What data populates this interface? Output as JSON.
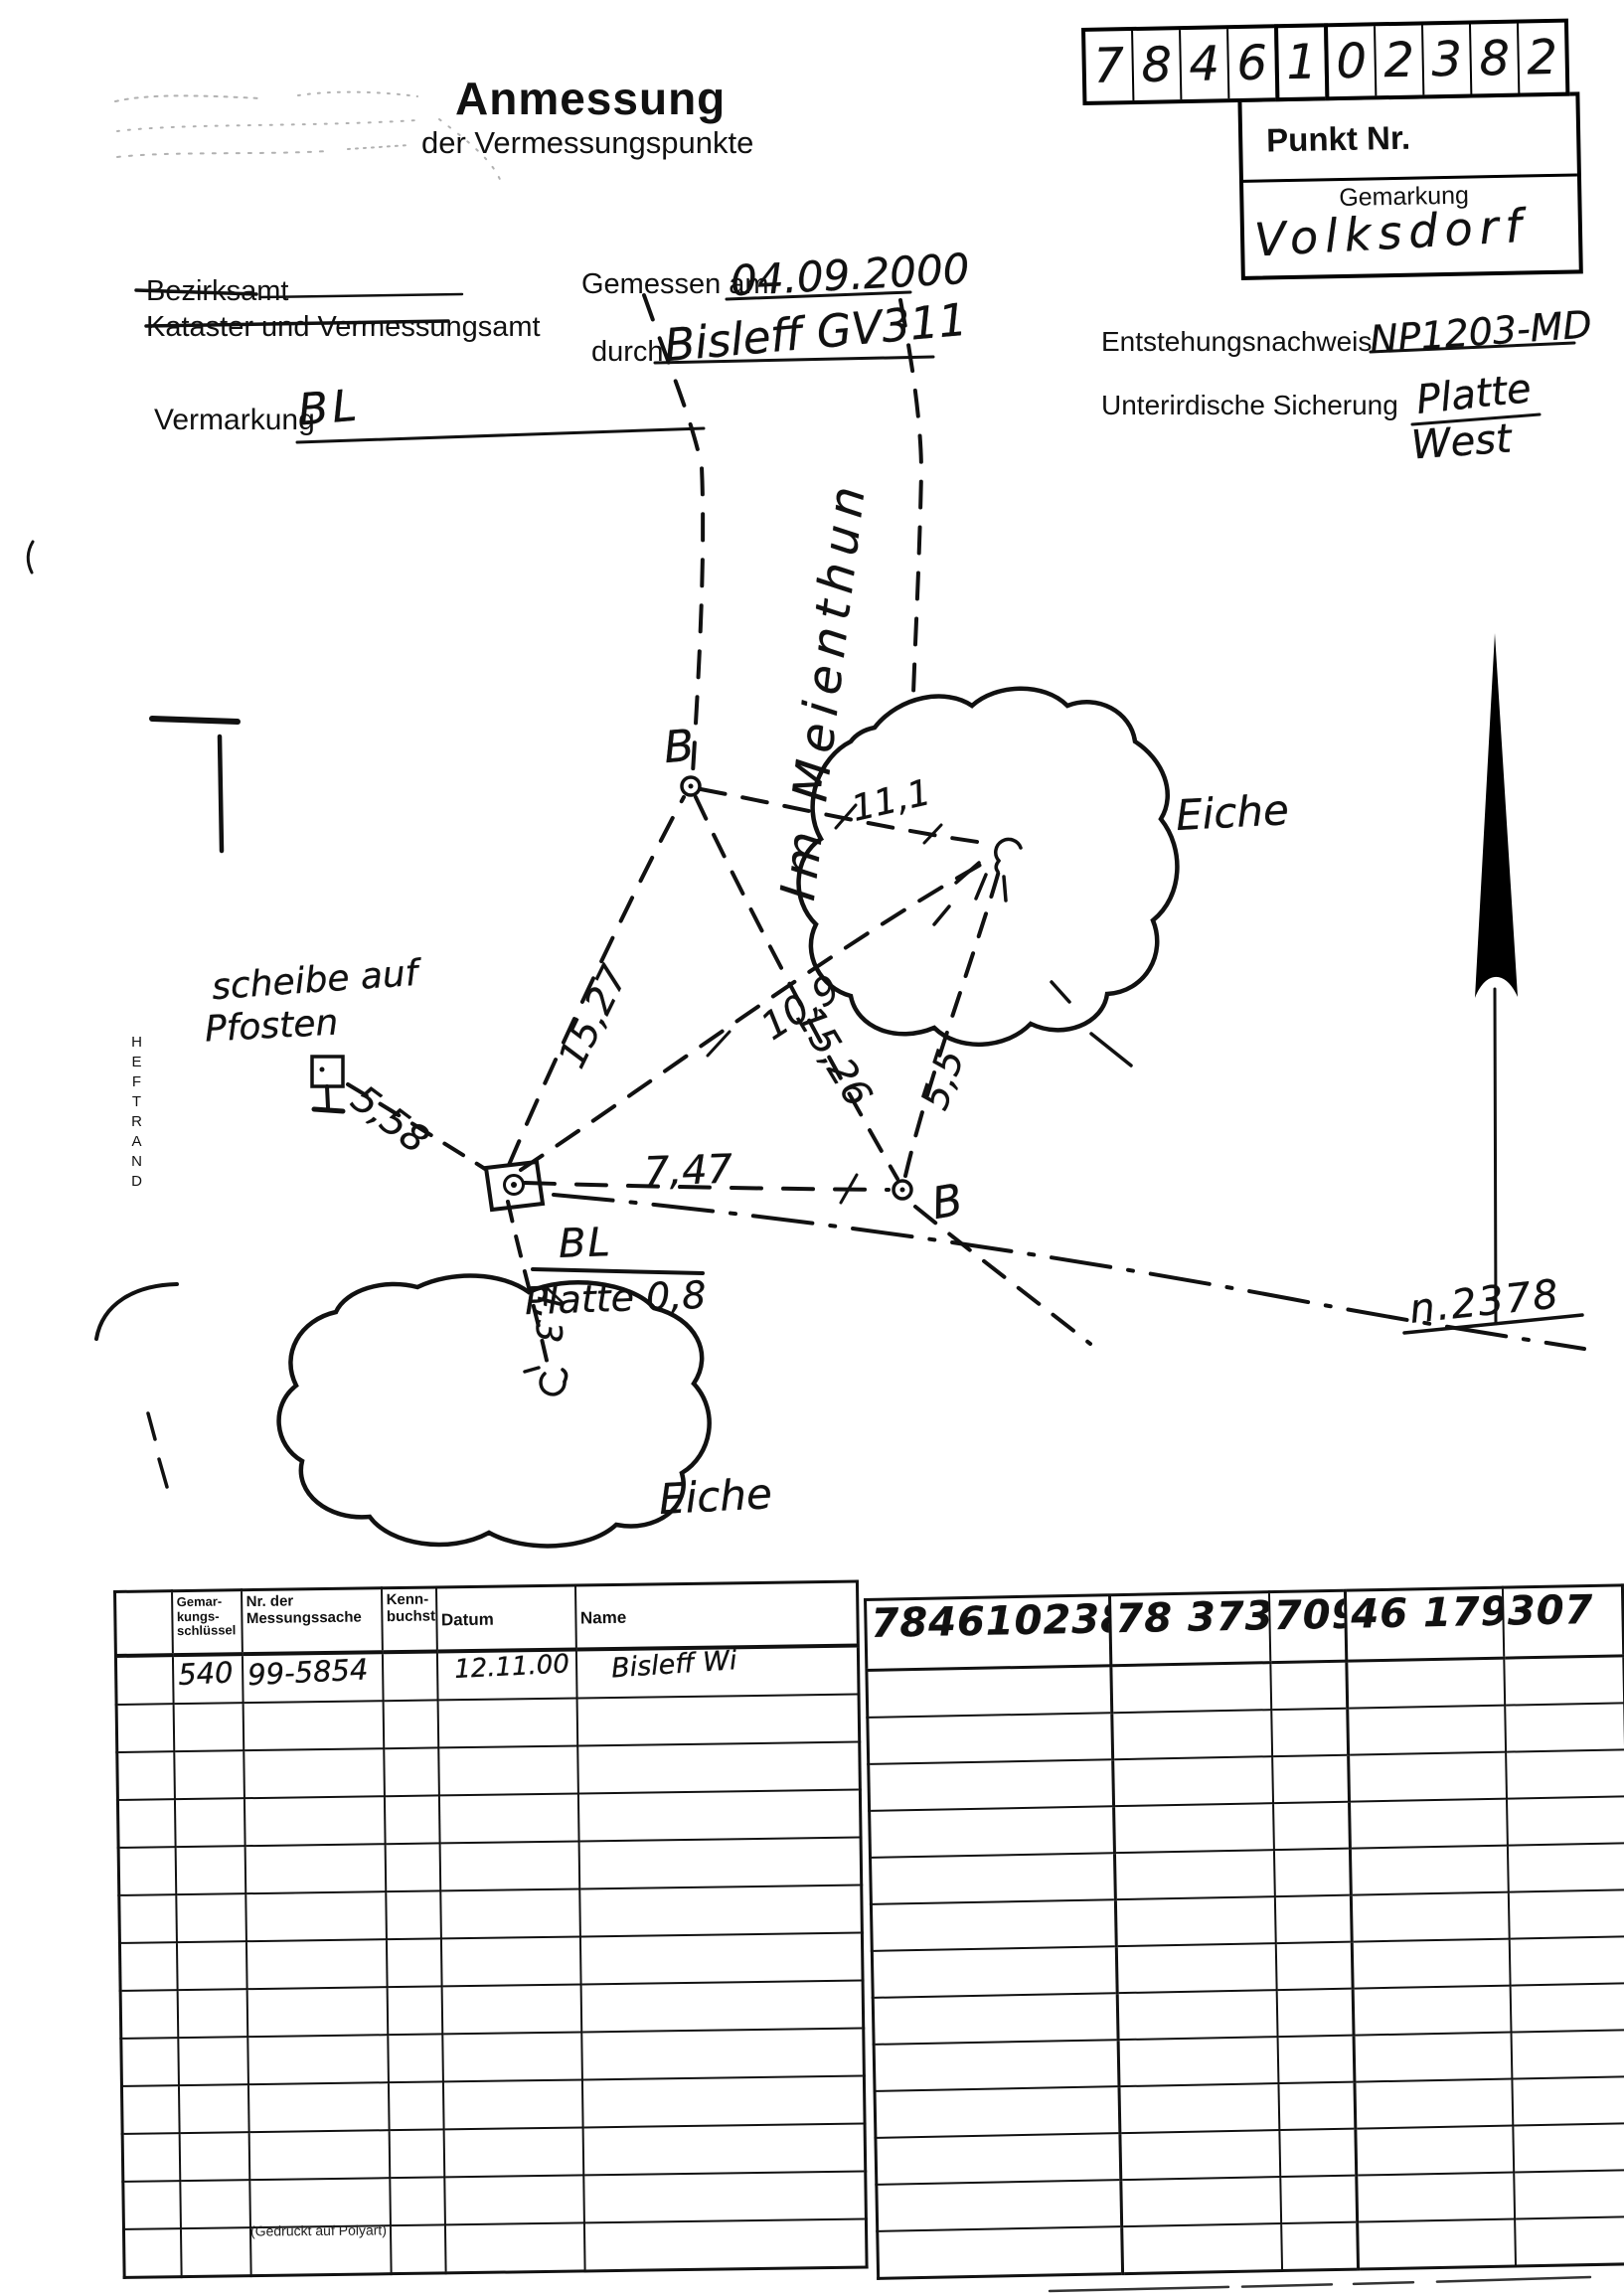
{
  "colors": {
    "paper": "#ffffff",
    "ink": "#111111"
  },
  "form": {
    "title": "Anmessung",
    "subtitle": "der Vermessungspunkte",
    "office_line1": "Bezirksamt",
    "office_line2": "Kataster und Vermessungsamt",
    "measured_on_label": "Gemessen am",
    "measured_on_value": "04.09.2000",
    "measured_by_label": "durch",
    "measured_by_value": "Bisleff GV311",
    "vermarkung_label": "Vermarkung",
    "vermarkung_value": "BL",
    "entstehungsnachweis_label": "Entstehungsnachweis",
    "entstehungsnachweis_value": "NP1203-MD",
    "sicherung_label": "Unterirdische Sicherung",
    "sicherung_value_line1": "Platte",
    "sicherung_value_line2": "West"
  },
  "punkt_box": {
    "digits_group1": [
      "7",
      "8",
      "4",
      "6"
    ],
    "digits_group2": [
      "1"
    ],
    "digits_group3": [
      "0",
      "2",
      "3",
      "8",
      "2"
    ],
    "punkt_nr_label": "Punkt Nr.",
    "gemarkung_label": "Gemarkung",
    "gemarkung_value": "Volksdorf"
  },
  "sketch": {
    "street_name": "Im Meienthun",
    "heftrand": "HEFTRAND",
    "point_b_top": "B",
    "point_b_right": "B",
    "tree_right_label": "Eiche",
    "tree_bottom_label": "Eiche",
    "post_label_line1": "scheibe auf",
    "post_label_line2": "Pfosten",
    "center_point_label_line1": "BL",
    "center_point_label_line2": "Platte 0,8",
    "neighbor_point_label": "n.2378",
    "measurements": {
      "square_to_b_top": "15,27",
      "square_to_tree": "10,9",
      "b_top_to_b_right": "15,26",
      "b_right_to_tree": "5,5",
      "b_top_to_tree": "11,1",
      "post_to_square": "5,58",
      "square_to_b_right": "7,47",
      "square_to_tree_bottom": "4,3"
    }
  },
  "table_left": {
    "headers": {
      "col1": "",
      "col2": "Gemar-\nkungs-\nschlüssel",
      "col3": "Nr. der\nMessungssache",
      "col4": "Kenn-\nbuchst.",
      "col5": "Datum",
      "col6": "Name"
    },
    "row1": {
      "gemarkungsschluessel": "540",
      "messungssache": "99-5854",
      "kennbuchst": "",
      "datum": "12.11.00",
      "name": "Bisleff Wi"
    },
    "empty_rows": 12
  },
  "table_right": {
    "row1": [
      "7846102382",
      "78 373",
      "709",
      "46 179",
      "307"
    ],
    "empty_rows": 13
  },
  "footer_note": "(Gedruckt auf Polyart)"
}
